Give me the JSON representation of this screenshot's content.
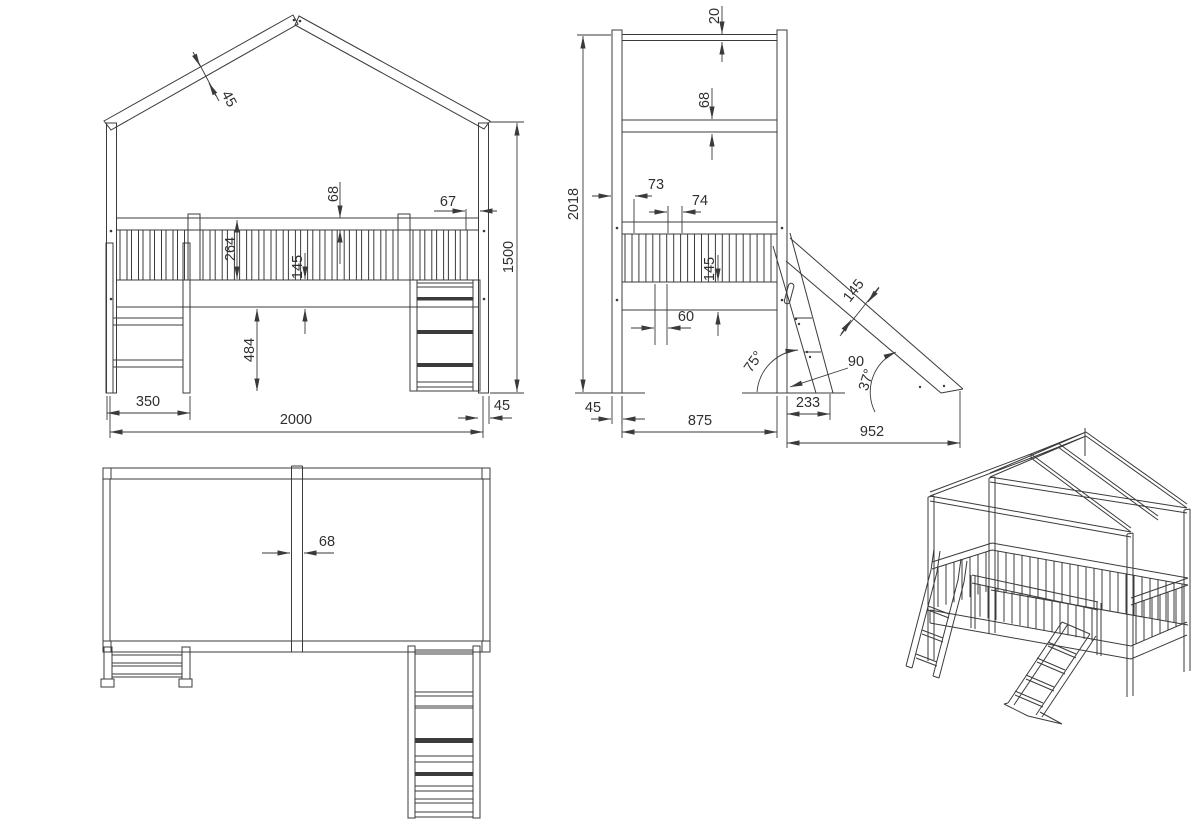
{
  "drawing": {
    "subject": "house loft bed with ladder and slide - dimensioned orthographic views",
    "colors": {
      "background": "#ffffff",
      "line": "#3b3b3b",
      "dim_text": "#2f2f2f"
    }
  },
  "views": {
    "front": {
      "dims": {
        "roof_board": "45",
        "top_rail": "68",
        "rail_inset": "67",
        "guardrail": "264",
        "frame_board": "145",
        "clearance": "484",
        "eave_height": "1500",
        "ladder_span": "350",
        "length": "2000",
        "post": "45"
      }
    },
    "side": {
      "dims": {
        "ridge_beam": "20",
        "eave_rail": "68",
        "total_height": "2018",
        "post_slat_gap": "73",
        "slat_pitch": "74",
        "frame_board": "145",
        "slat_width": "60",
        "slide_board": "145",
        "ladder_angle": "75°",
        "stringer": "90",
        "slide_angle": "37°",
        "post": "45",
        "depth": "875",
        "ladder_run": "233",
        "slide_run": "952"
      }
    },
    "plan": {
      "dims": {
        "center_rail": "68"
      }
    }
  }
}
